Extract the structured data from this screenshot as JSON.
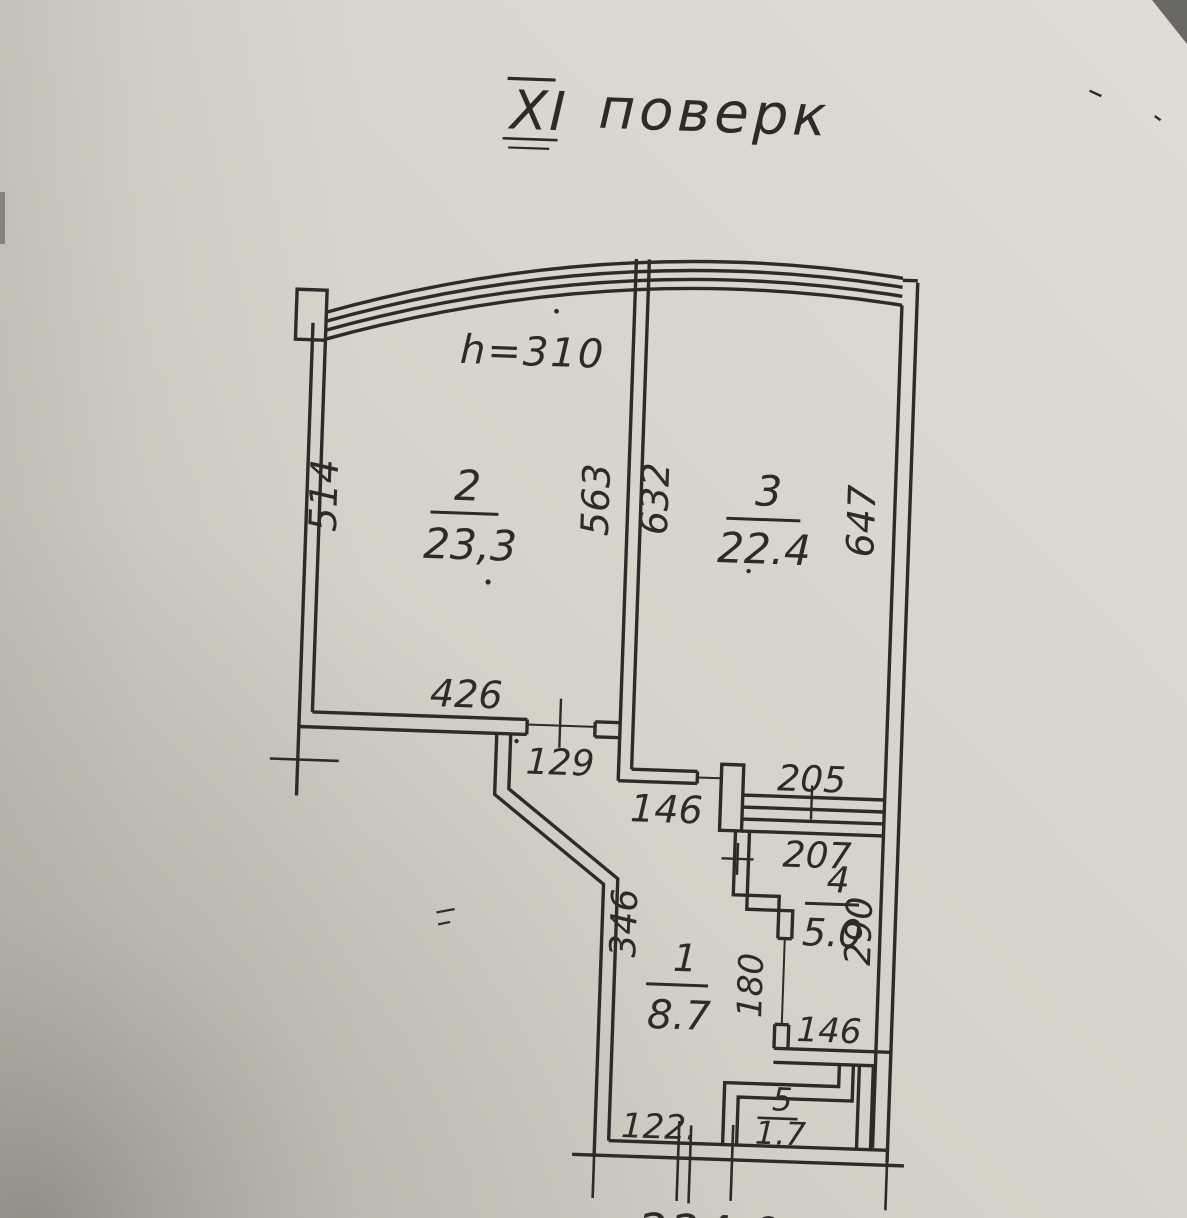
{
  "doc": {
    "title_numeral": "XI",
    "title_word": "поверк",
    "height_note": "h=310",
    "bottom_partial": "224.9"
  },
  "rooms": {
    "room1": {
      "number": "1",
      "area": "8.7"
    },
    "room2": {
      "number": "2",
      "area": "23,3"
    },
    "room3": {
      "number": "3",
      "area": "22.4"
    },
    "room4": {
      "number": "4",
      "area": "5.0"
    },
    "room5": {
      "number": "5",
      "area": "1.7"
    }
  },
  "dims": {
    "left_wall_height": "514",
    "room2_width": "563",
    "room3_width": "632",
    "right_wall_upper": "647",
    "room2_bottom_width": "426",
    "room2_door_width": "129",
    "hall_opening": "146",
    "room3_bottom_width": "205",
    "room4_top_width": "207",
    "room4_right_height": "290",
    "hall_left_height": "346",
    "room4_door_height": "180",
    "room4_bottom_width": "146",
    "hall_bottom_width": "122."
  },
  "colors": {
    "paper": "#d7d3ca",
    "ink": "#2d2b28",
    "shadow": "#807c74"
  }
}
